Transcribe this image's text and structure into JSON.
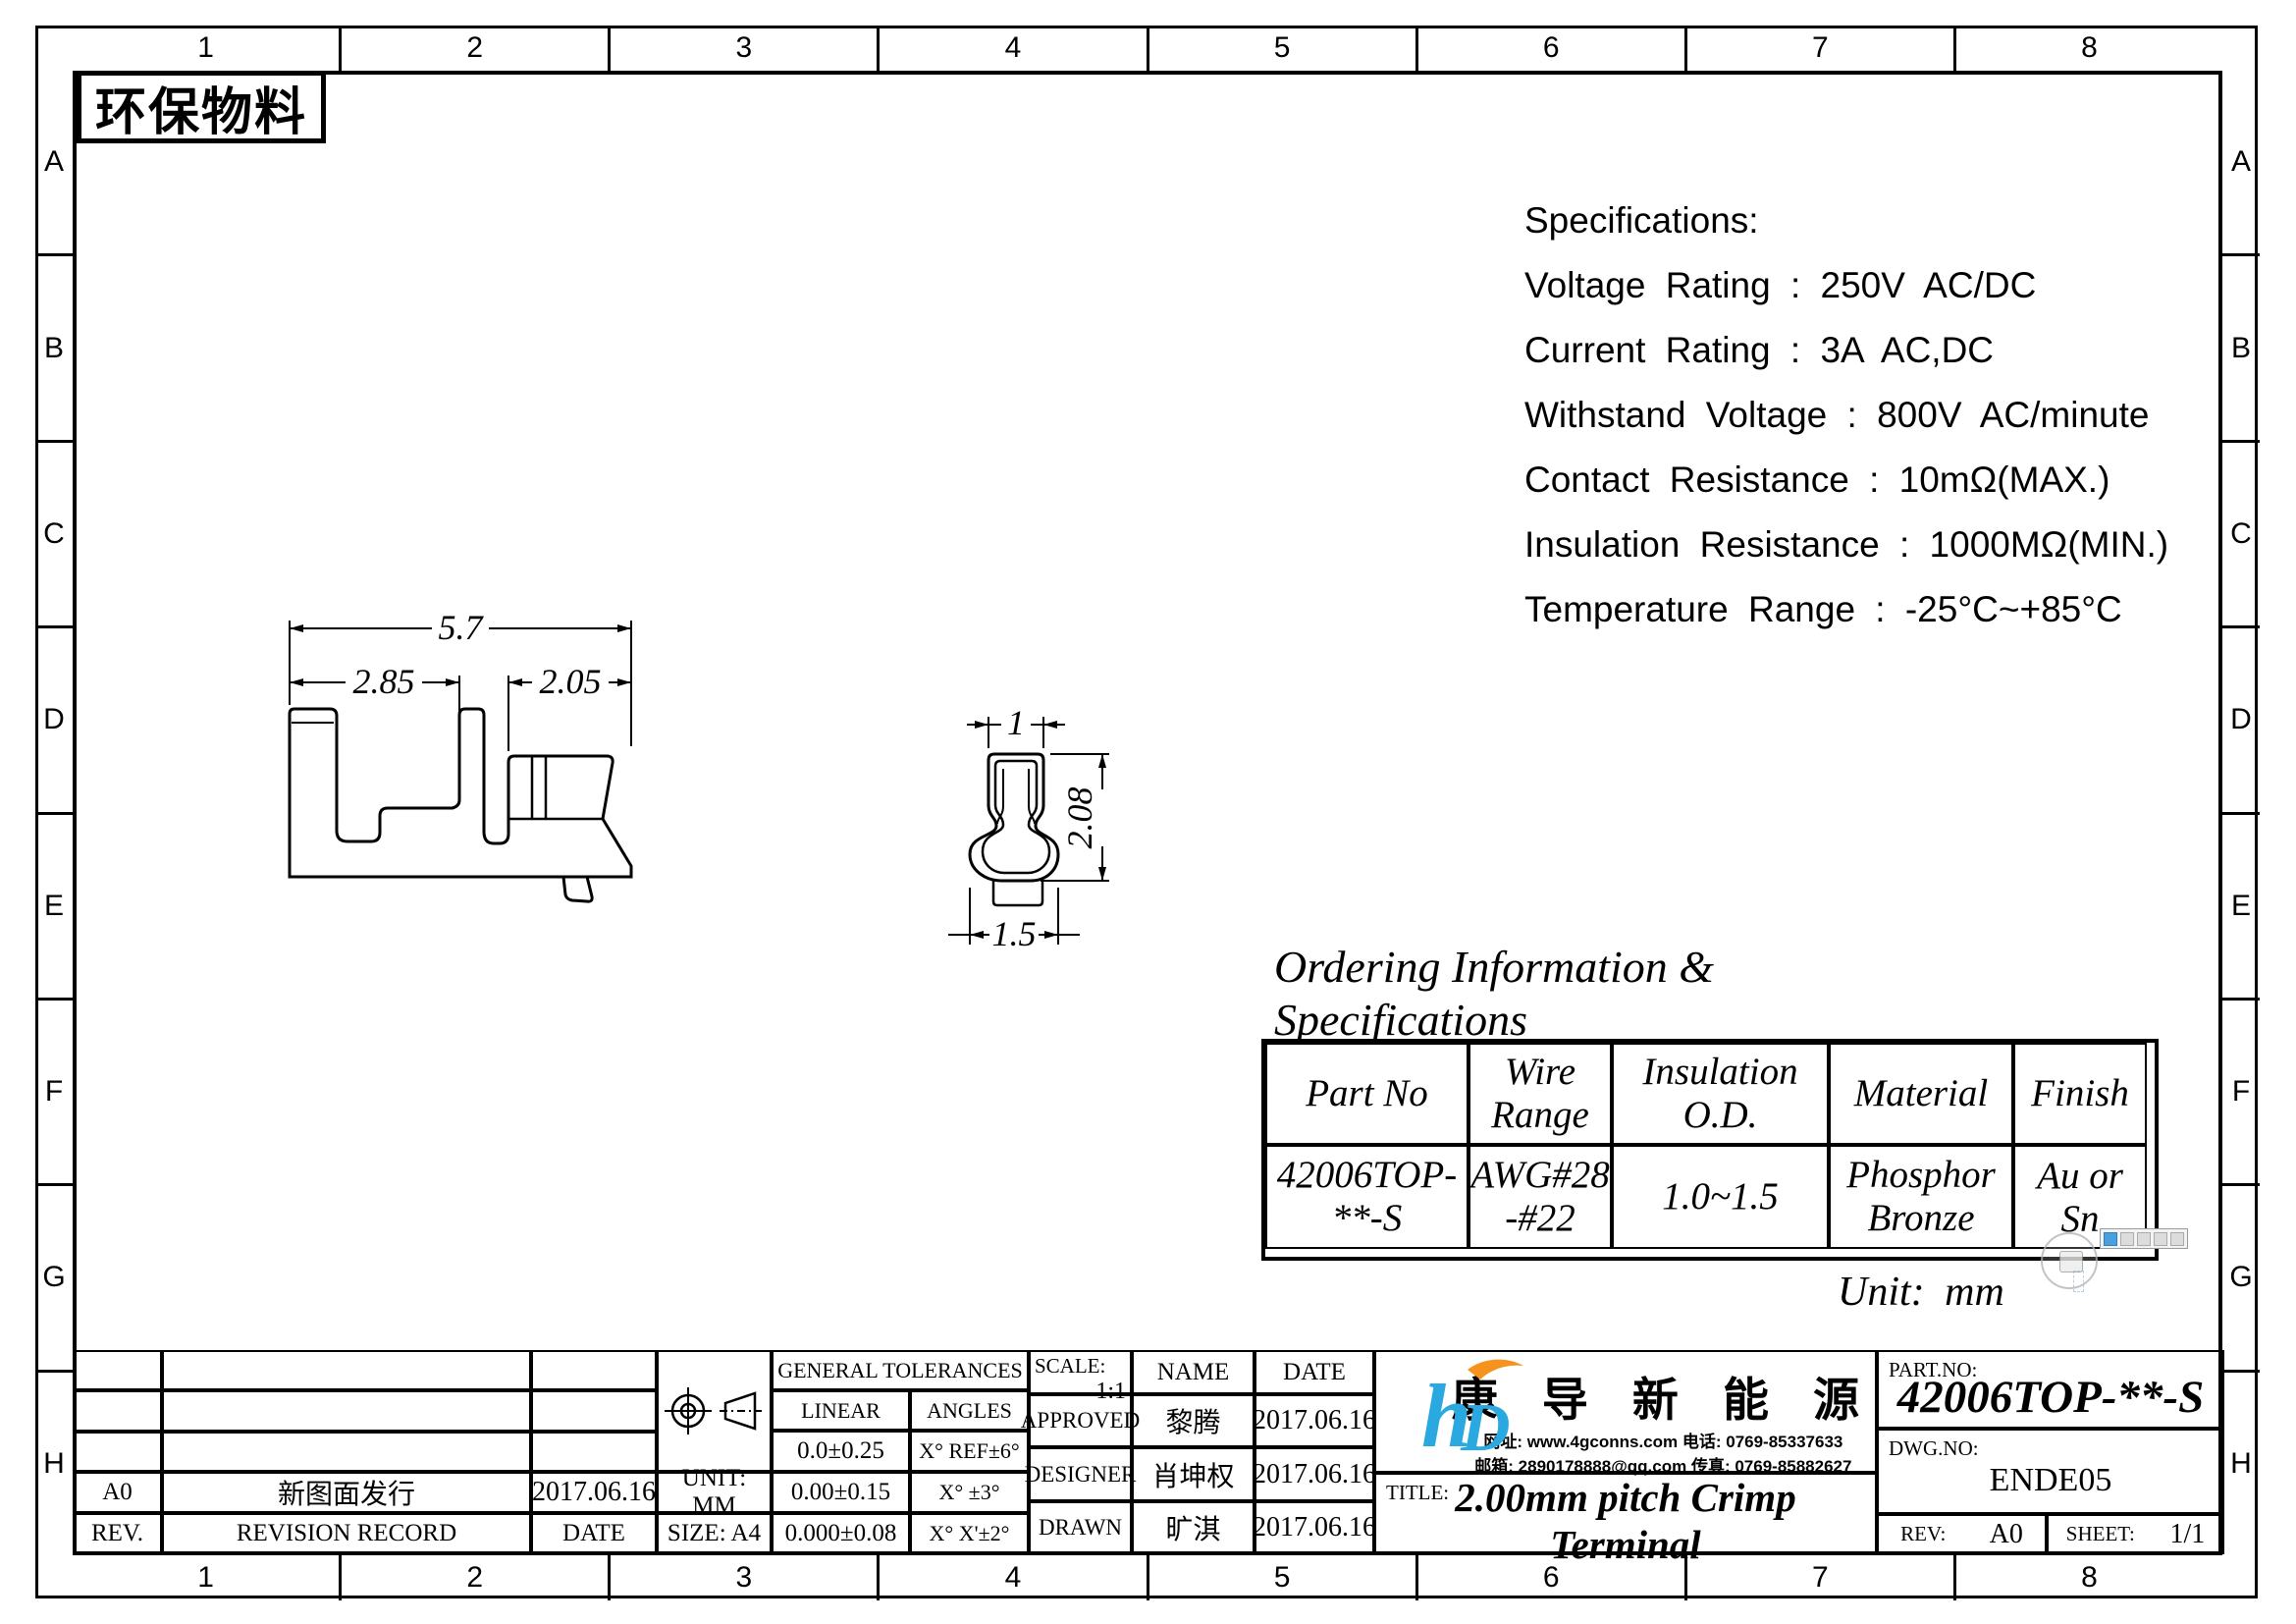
{
  "badge": {
    "text": "环保物料"
  },
  "zones": {
    "columns": [
      "1",
      "2",
      "3",
      "4",
      "5",
      "6",
      "7",
      "8"
    ],
    "rows": [
      "A",
      "B",
      "C",
      "D",
      "E",
      "F",
      "G",
      "H"
    ]
  },
  "specifications": {
    "title": "Specifications:",
    "lines": [
      "Voltage Rating : 250V AC/DC",
      "Current Rating : 3A AC,DC",
      "Withstand Voltage : 800V AC/minute",
      "Contact Resistance : 10mΩ(MAX.)",
      "Insulation Resistance : 1000MΩ(MIN.)",
      "Temperature Range : -25°C~+85°C"
    ]
  },
  "drawings": {
    "side_view": {
      "dims": {
        "total": "5.7",
        "left": "2.85",
        "right": "2.05"
      }
    },
    "end_view": {
      "dims": {
        "top": "1",
        "height": "2.08",
        "bottom": "1.5"
      }
    },
    "unit_note": "Unit: mm"
  },
  "ordering": {
    "title_line1": "Ordering Information &",
    "title_line2": "Specifications",
    "headers": [
      "Part No",
      "Wire\nRange",
      "Insulation\nO.D.",
      "Material",
      "Finish"
    ],
    "row": [
      "42006TOP-\n**-S",
      "AWG#28\n-#22",
      "1.0~1.5",
      "Phosphor\nBronze",
      "Au or Sn"
    ]
  },
  "title_block": {
    "revision": {
      "rev_value": "A0",
      "record_value": "新图面发行",
      "date_value": "2017.06.16",
      "rev_header": "REV.",
      "record_header": "REVISION RECORD",
      "date_header": "DATE"
    },
    "unit": "UNIT: MM",
    "size": "SIZE: A4",
    "tolerances": {
      "title": "GENERAL TOLERANCES",
      "linear_label": "LINEAR",
      "angles_label": "ANGLES",
      "linear_rows": [
        "0.0±0.25",
        "0.00±0.15",
        "0.000±0.08"
      ],
      "angle_rows": [
        "X° REF±6°",
        "X° ±3°",
        "X° X'±2°"
      ]
    },
    "scale_label": "SCALE:",
    "scale_value": "1:1",
    "name_header": "NAME",
    "date_header": "DATE",
    "signoff": [
      {
        "role": "APPROVED",
        "name": "黎腾",
        "date": "2017.06.16"
      },
      {
        "role": "DESIGNER",
        "name": "肖坤权",
        "date": "2017.06.16"
      },
      {
        "role": "DRAWN",
        "name": "旷淇",
        "date": "2017.06.16"
      }
    ],
    "company": {
      "logo_h": "h",
      "logo_d": "D",
      "name": "康 导 新 能 源",
      "contact_line1": "网址: www.4gconns.com    电话: 0769-85337633",
      "contact_line2": "邮箱: 2890178888@qq.com 传真: 0769-85882627"
    },
    "title_label": "TITLE:",
    "drawing_title": "2.00mm pitch Crimp Terminal",
    "part_no_label": "PART.NO:",
    "part_no": "42006TOP-**-S",
    "dwg_no_label": "DWG.NO:",
    "dwg_no": "ENDE05",
    "rev_label": "REV:",
    "rev_value": "A0",
    "sheet_label": "SHEET:",
    "sheet_value": "1/1"
  },
  "colors": {
    "line": "#000000",
    "logo_blue": "#2aa9e0",
    "logo_orange": "#f6921e"
  }
}
